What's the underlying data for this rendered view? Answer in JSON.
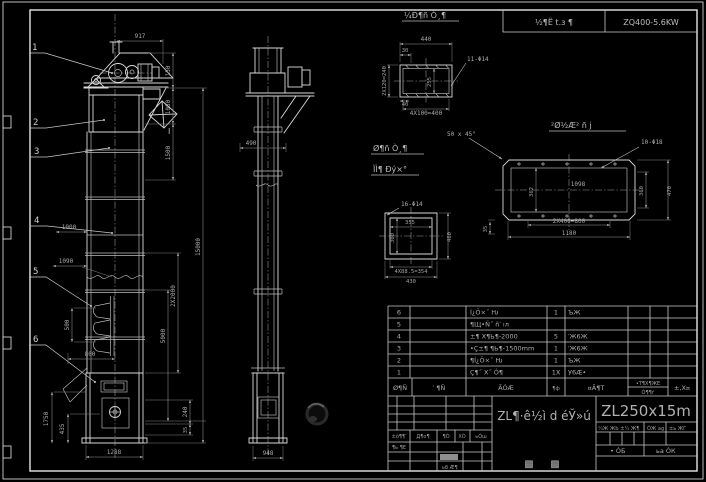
{
  "style": {
    "background": "#000000",
    "line_color": "#d9d9d9",
    "dim_color": "#969696",
    "text_color": "#b5b5b5"
  },
  "header": {
    "project_label": "½¶Ё t.з ¶",
    "drive_spec": "ZQ400-5.6KW"
  },
  "balloons": {
    "b1": "1",
    "b2": "2",
    "b3": "3",
    "b4": "4",
    "b5": "5",
    "b6": "6"
  },
  "front_dims": {
    "w917": "917",
    "h150": "150",
    "h1080": "1080",
    "h1500": "1500",
    "h2x2000": "2X2000",
    "h5000": "5000",
    "h15000": "15000",
    "w1000": "1000",
    "w1090": "1090",
    "p500": "500",
    "w800": "800",
    "h1750": "1750",
    "h435": "435",
    "h240": "240",
    "h35": "35",
    "w1288": "1288",
    "section_mark": "I"
  },
  "side_dims": {
    "w490": "490",
    "w948": "948"
  },
  "detail_top": {
    "title": "¼Ð¶ñ Ò¸¶",
    "w440": "440",
    "w30": "30",
    "h2x120": "2X120=240",
    "h255": "255",
    "w40": "40",
    "w4x100": "4X100=400",
    "holes": "11-Φ14"
  },
  "detail_square": {
    "title_line1": "Ø¶ñ Ò¸¶",
    "title_line2": "ÏÌ¶ Ðý×°",
    "holes": "16-Φ14",
    "w355": "355",
    "h300": "300",
    "h460": "460",
    "w4x885": "4X88.5=354",
    "w430": "430"
  },
  "detail_long": {
    "title": "²Ø½Æ² ñ ј",
    "chamfer": "50 x 45°",
    "holes": "10-Φ18",
    "w1098": "1098",
    "h362": "362",
    "h360": "360",
    "h470": "470",
    "w2x400": "2X400=800",
    "w1180": "1180",
    "h35": "35"
  },
  "bom": {
    "rows": [
      {
        "no": "6",
        "desc": "Í¿Ö×˝ Ƕ",
        "qty": "1",
        "mat": "ЪЖ"
      },
      {
        "no": "5",
        "desc": "¶Щ•Ñ˝ ñ′ ıл",
        "qty": "",
        "mat": ""
      },
      {
        "no": "4",
        "desc": "±¶ X¶Ь¶-2000",
        "qty": "5",
        "mat": "′Ж6Ж"
      },
      {
        "no": "3",
        "desc": "•Ç±¶ ¶Ь¶-1500mm",
        "qty": "1",
        "mat": "′Ж6Ж"
      },
      {
        "no": "2",
        "desc": "¶Í¿Ö×˝ Ƕ",
        "qty": "1",
        "mat": "ЪЖ"
      },
      {
        "no": "1",
        "desc": "Ç¶˝ X˝ Ó¶",
        "qty": "1X",
        "mat": "У6Æ•"
      }
    ],
    "footer": {
      "col_no": "Ø¶Ñ",
      "col_code": "′ ¶Ñ",
      "col_name": "ÃÓÆ",
      "col_qty": "¶ф",
      "col_note": "¤Ã¶Т",
      "weight_top": "•Т¶Х¶ЖЕ",
      "weight_bottom": "Ó¶¶ѓ",
      "scale": "±‚Х¤"
    }
  },
  "titleblock": {
    "model": "ZL250x15m",
    "product_title": "ZL¶·ê½ì d éЎ»ú",
    "sheet_box1": "▩",
    "sheet_box2": "▩",
    "rev_cells": [
      "±ò¶¶′",
      "Д¶о¶",
      "¶Ó",
      "ХÓ",
      "ьÓш"
    ],
    "design_label": "¶ь ¶Е",
    "approve_label": "ьб Æ¶",
    "right_header": "¼Ж ЖЬ ±¼ Ж¶",
    "right_sign": "ÓЖ ag",
    "right_date": "±ь ЖГ",
    "stage_left": "• ÓБ",
    "stage_right": "ьа ÓК"
  }
}
